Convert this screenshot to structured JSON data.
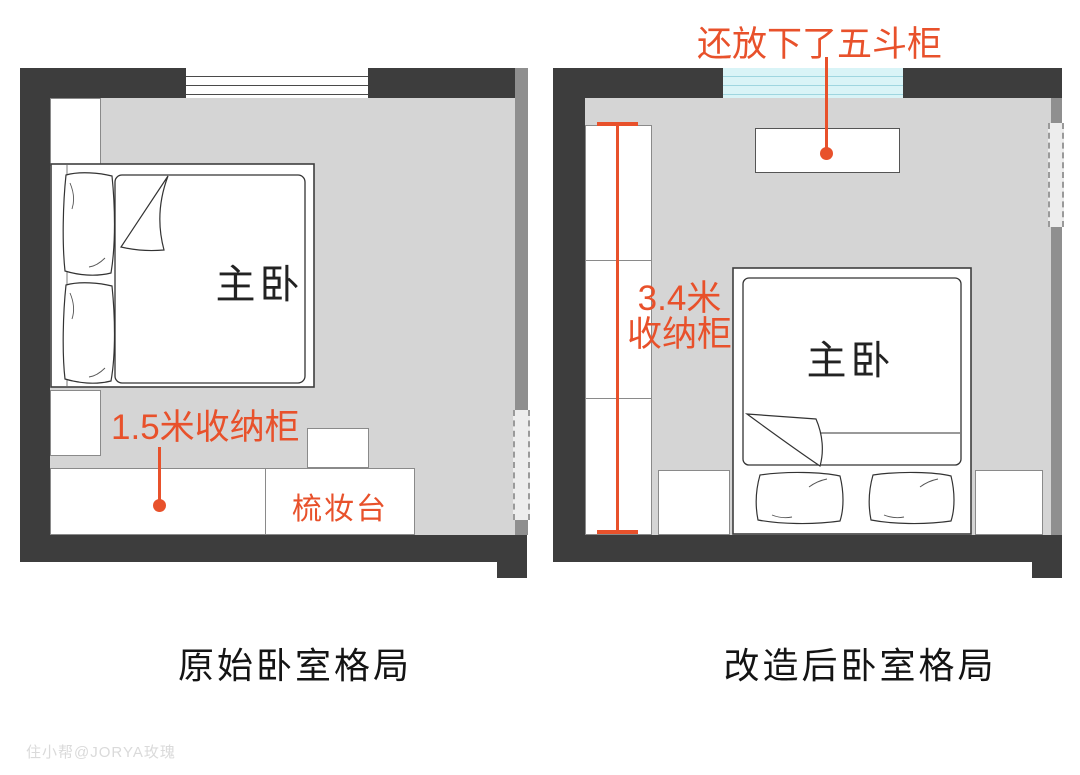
{
  "colors": {
    "annotation_orange": "#e8512b",
    "wall_dark": "#3d3d3d",
    "wall_mid": "#8f8f8f",
    "floor_gray": "#d5d5d5",
    "window_cyan": "#d9f4f7"
  },
  "left_plan": {
    "room_label": "主卧",
    "cabinet_annotation": "1.5米收纳柜",
    "dresser_label": "梳妆台",
    "caption": "原始卧室格局"
  },
  "right_plan": {
    "room_label": "主卧",
    "chest_annotation": "还放下了五斗柜",
    "cabinet_annotation_line1": "3.4米",
    "cabinet_annotation_line2": "收纳柜",
    "caption": "改造后卧室格局"
  },
  "watermark": "住小帮@JORYA玫瑰"
}
